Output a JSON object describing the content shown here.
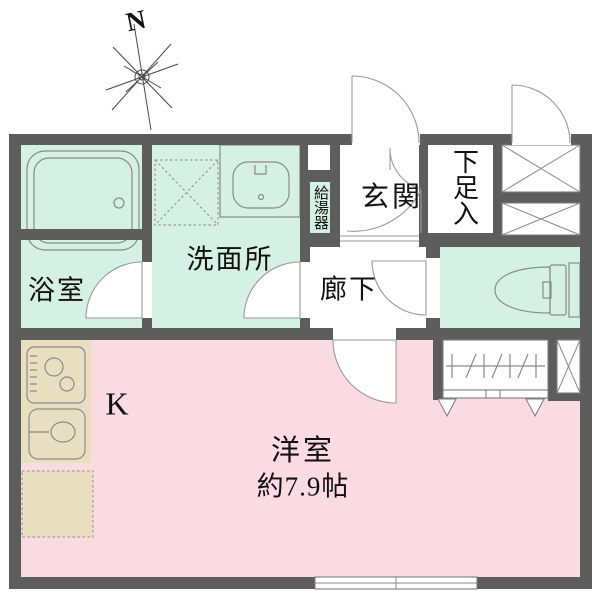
{
  "compass": {
    "label": "N"
  },
  "rooms": {
    "bathroom": {
      "label": "浴室"
    },
    "washroom": {
      "label": "洗面所"
    },
    "entrance": {
      "label": "玄関"
    },
    "shoe_storage": {
      "label": "下足入"
    },
    "water_heater": {
      "label": "給湯器"
    },
    "corridor": {
      "label": "廊下"
    },
    "kitchen": {
      "label": "K"
    },
    "western_room": {
      "label": "洋室",
      "size_label": "約7.9帖"
    }
  },
  "colors": {
    "wall": "#5d5d5d",
    "bath_area": "#d5f0e4",
    "room": "#fbdbe2",
    "kitchen_counter": "#e8dfc1",
    "outline": "#8a8a8a"
  }
}
